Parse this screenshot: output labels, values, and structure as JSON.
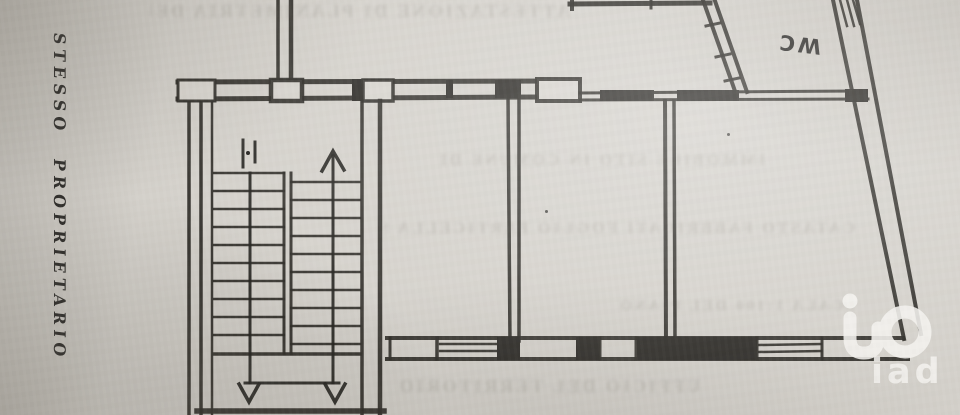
{
  "document": {
    "kind": "scanned floor plan photo",
    "labels": {
      "owner_note": "STESSO PROPRIETARIO",
      "wc": "WC"
    },
    "watermark": {
      "text": "iad"
    },
    "bleed_through": {
      "note": "illegible mirrored text showing through the paper",
      "rows": [
        {
          "text": "ATTESTAZIONE DI PLANIMETRIA DEL PIANO"
        },
        {
          "text": "IMMOBILE SITO IN COMUNE DI"
        },
        {
          "text": "CATASTO FABBRICATI FOGLIO PARTICELLA SUB"
        },
        {
          "text": "SCALA 1:100 DEL PIANO"
        },
        {
          "text": "UFFICIO DEL TERRITORIO"
        }
      ]
    },
    "colors": {
      "paper": "#d4d1cb",
      "ink": "#292723",
      "watermark_white": "#f4f3ef"
    }
  }
}
